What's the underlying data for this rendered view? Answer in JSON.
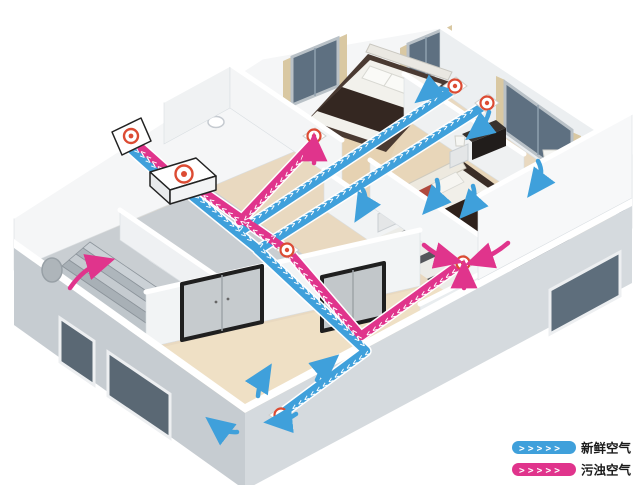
{
  "legend": {
    "items": [
      {
        "id": "fresh-air",
        "label": "新鲜空气",
        "color": "#3FA0DB"
      },
      {
        "id": "polluted-air",
        "label": "污浊空气",
        "color": "#E0348C"
      }
    ]
  },
  "colors": {
    "fresh_air": "#3FA0DB",
    "polluted_air": "#E0348C",
    "vent_ring": "#DC4B33"
  },
  "system": {
    "unit_icon": "heat-recovery-ventilator",
    "vent_icons": [
      "outdoor-wall-vent",
      "bedroom1-supply-vent",
      "bedroom2-supply-vent",
      "bathroom-exhaust-vent",
      "hallway-exhaust-vent",
      "bedroom2-exhaust-vent",
      "living-room-supply-vent"
    ]
  }
}
